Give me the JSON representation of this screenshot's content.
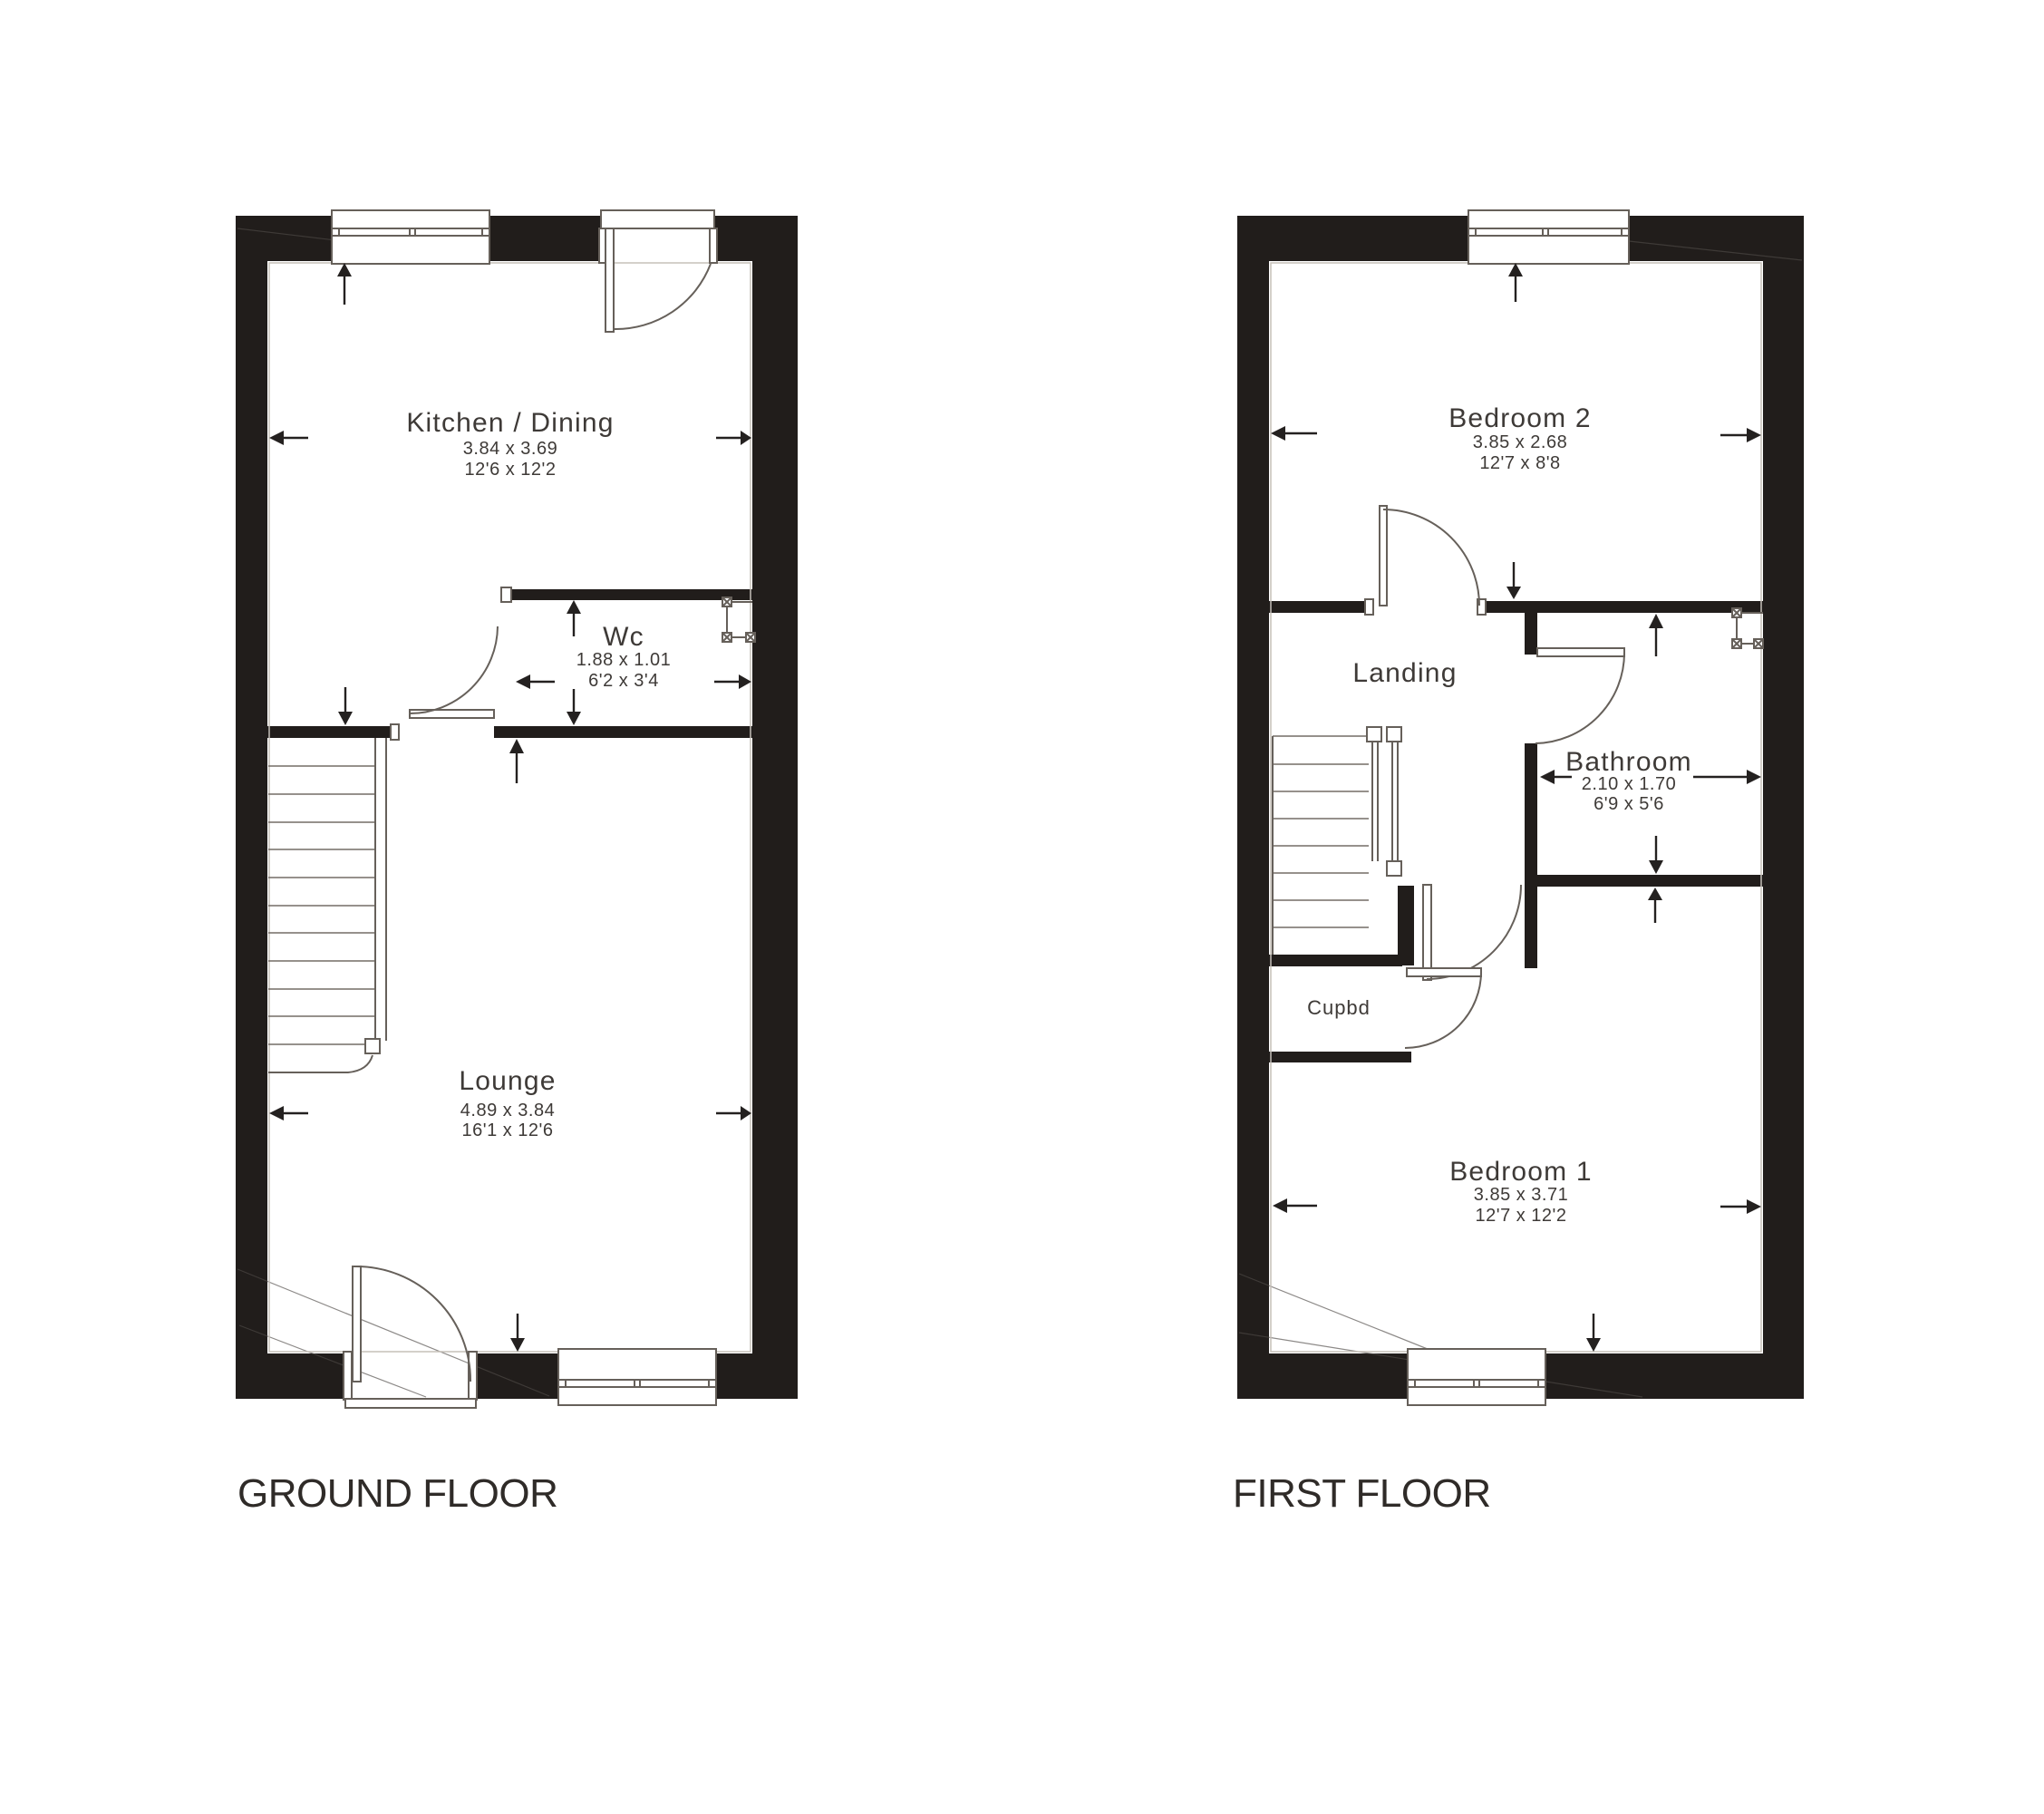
{
  "colors": {
    "wall": "#211d1b",
    "line": "#66605a",
    "text": "#3e3a37",
    "title": "#2f2b28",
    "arrow": "#242120"
  },
  "ground_floor": {
    "title": "GROUND FLOOR",
    "rooms": {
      "kitchen": {
        "name": "Kitchen / Dining",
        "metric": "3.84 x 3.69",
        "imperial": "12'6 x 12'2"
      },
      "wc": {
        "name": "Wc",
        "metric": "1.88 x 1.01",
        "imperial": "6'2 x 3'4"
      },
      "lounge": {
        "name": "Lounge",
        "metric": "4.89 x 3.84",
        "imperial": "16'1 x 12'6"
      }
    }
  },
  "first_floor": {
    "title": "FIRST FLOOR",
    "rooms": {
      "bedroom2": {
        "name": "Bedroom 2",
        "metric": "3.85 x 2.68",
        "imperial": "12'7 x 8'8"
      },
      "landing": {
        "name": "Landing"
      },
      "bathroom": {
        "name": "Bathroom",
        "metric": "2.10 x 1.70",
        "imperial": "6'9 x 5'6"
      },
      "cupboard": {
        "name": "Cupbd"
      },
      "bedroom1": {
        "name": "Bedroom 1",
        "metric": "3.85 x 3.71",
        "imperial": "12'7 x 12'2"
      }
    }
  }
}
